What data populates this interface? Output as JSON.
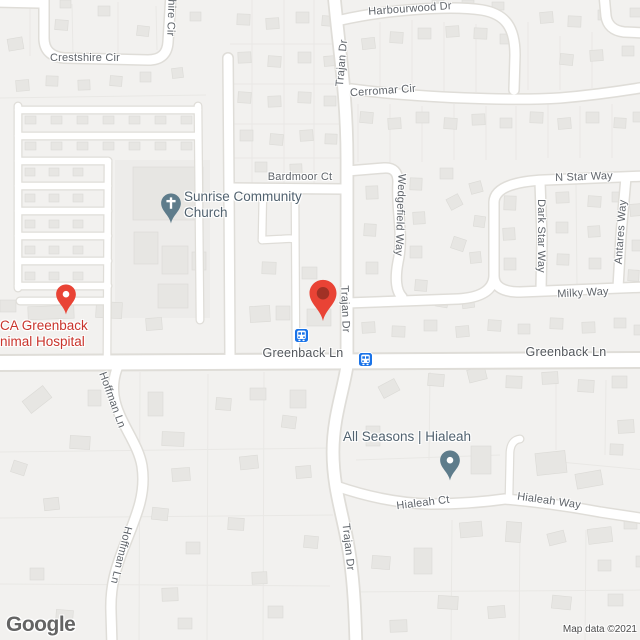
{
  "attribution": "Map data ©2021",
  "logo_text": "Google",
  "colors": {
    "pin_red": "#e94335",
    "pin_red_dark": "#8f2d22",
    "poi_slate": "#5e7c8b",
    "transit_blue": "#1a73e8",
    "poi_text": "#51626f",
    "poi_text_red": "#c9342c",
    "road_label": "#5f646a"
  },
  "roads": {
    "crestshire": "Crestshire Cir",
    "shire": "shire Cir",
    "harbourwood": "Harbourwood Dr",
    "trajan_top": "Trajan Dr",
    "cerromar": "Cerromar Cir",
    "bardmoor": "Bardmoor Ct",
    "n_star": "N Star Way",
    "wedgefield": "Wedgefield Way",
    "dark_star": "Dark Star Way",
    "antares": "Antares Way",
    "milky": "Milky Way",
    "greenback_left": "Greenback Ln",
    "greenback_right": "Greenback Ln",
    "trajan_mid": "Trajan Dr",
    "trajan_bottom": "Trajan Dr",
    "hoffman_top": "Hoffman Ln",
    "hoffman_bottom": "Hoffman Ln",
    "hialeah_ct": "Hialeah Ct",
    "hialeah_way": "Hialeah Way"
  },
  "pois": {
    "church": {
      "name_line1": "Sunrise Community",
      "name_line2": "Church"
    },
    "animal_hospital": {
      "name_line1": "CA Greenback",
      "name_line2": "nimal Hospital"
    },
    "all_seasons": {
      "name": "All Seasons | Hialeah"
    }
  }
}
